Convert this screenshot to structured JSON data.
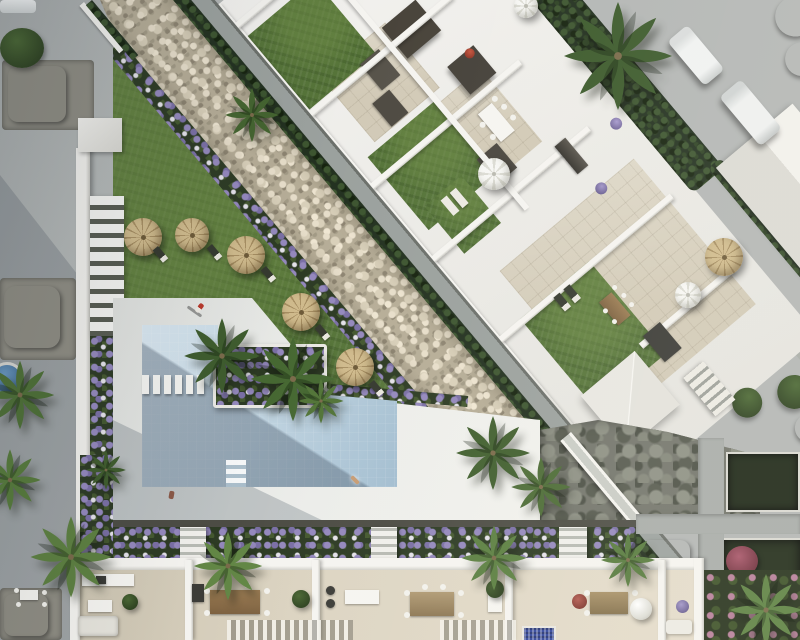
{
  "scene": {
    "title": "Aerial 3D architectural render of a residential complex with communal pool and garden",
    "style": "top-down photorealistic CGI, afternoon light from upper right",
    "areas": {
      "street_left": "asphalt street with stone-edged planting beds",
      "street_top_right": "access road with two parked white vans",
      "gravel_bank": "diagonal decorative pebble bank with clipped hedges and footpath",
      "roof_terraces": "white apartment block rooftops with lawns, tiled patios and outdoor furniture",
      "penthouse_terrace": "large corner penthouse terrace with lawn, dining set and pyramid skylight",
      "pool_deck": "white sunbathing deck with standing figure",
      "pool": "L-shaped communal swimming pool with stepping-stone bridge and corner steps",
      "lawn_umbrellas": "communal lawn with straw parasols and sun loungers",
      "palm_island": "planter island with palms and purple flowers beside the pool",
      "flower_border": "flower border with three staircases above the townhouse row",
      "townhouses": "row of five townhouse terraces with kitchens, dining sets and pergolas",
      "stone_retaining_wall": "dark stone retaining wall with white access ramp",
      "side_garden": "right-hand garden strip with dark beds and red bush"
    },
    "palette": {
      "base_gray": "#b3b6b5",
      "deck_white": "#e8e9e6",
      "pool_light": "#d4e3ed",
      "pool_dark": "#9db9cc",
      "lawn_green": "#567439",
      "gravel_beige": "#c5bca6",
      "hedge_dark": "#233120",
      "roof_tile": "#d2cab7",
      "wall_white": "#f1f0ec",
      "stone_wall": "#73756c",
      "straw_umbrella": "#cfba8c",
      "white_parasol": "#f7f7f4",
      "flower_purple": "#9488bd",
      "plunge_pool_blue": "#30459c",
      "accent_red": "#a03c2e"
    },
    "inventory": {
      "straw_umbrellas": 6,
      "white_parasols": 3,
      "parked_vans": 2,
      "people": 3,
      "palm_trees": 14,
      "townhouse_terraces": 5,
      "staircases": 4,
      "rooftop_lawns": 4
    },
    "people": [
      {
        "label": "person standing on pool deck",
        "clothing": "red top"
      },
      {
        "label": "person swimming in pool"
      },
      {
        "label": "person at lower deck edge"
      }
    ]
  }
}
